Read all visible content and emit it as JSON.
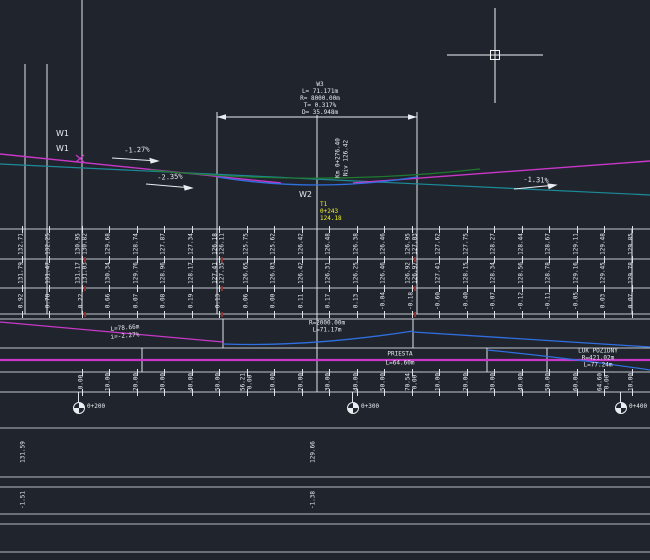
{
  "colors": {
    "background": "#20252d",
    "line_white": "#e9ecf1",
    "line_gray": "#b6bcc4",
    "magenta": "#c837c8",
    "teal": "#1d8a99",
    "blue": "#2f6fe0",
    "green": "#1f7a2f",
    "yellow": "#f2f22b",
    "red_tick": "#8b2f2f"
  },
  "annotations": {
    "w1_top": "W1",
    "w1_bottom": "W1",
    "w2": "W2",
    "w3_title": "W3",
    "w3_l": "L= 71.171m",
    "w3_r": "R= 8000.00m",
    "w3_t": "T= 0.317%",
    "w3_d": "D= 35.948m",
    "grade_left": "-1.27%",
    "grade_mid": "-2.35%",
    "grade_right": "-1.31%",
    "station_note_l1": "Km 0+276.40",
    "station_note_l2": "Niv 126.42",
    "vertex_l1": "T1",
    "vertex_l2": "0+243",
    "vertex_l3": "124.18"
  },
  "grade_diagram": {
    "seg_len": "L=78.66m",
    "seg_slope": "i=-2.27%",
    "curve_r": "R=2000.00m",
    "curve_len": "L=71.17m"
  },
  "alignment": {
    "tangent_name": "PRIESTA",
    "tangent_len": "L=64.60m",
    "curve_name": "LUK POZIDNY",
    "curve_r": "R=421.02m",
    "curve_len": "L=77.24m"
  },
  "bands": {
    "columns_x": [
      22,
      49,
      82,
      109,
      137,
      164,
      192,
      219,
      247,
      274,
      302,
      329,
      357,
      384,
      412,
      439,
      467,
      494,
      522,
      549,
      577,
      604,
      632
    ],
    "terrain": [
      "132.71",
      "132.25",
      "130.95|130.82",
      "129.68",
      "128.74",
      "127.87",
      "127.34",
      "126.18|126.11",
      "125.75",
      "125.62",
      "126.42",
      "126.48",
      "126.38",
      "126.46",
      "126.95|127.03",
      "127.62",
      "127.75",
      "128.27",
      "128.44",
      "128.67",
      "129.11",
      "129.48",
      "129.85"
    ],
    "design": [
      "131.79",
      "131.47",
      "131.17|131.03",
      "130.34",
      "129.76",
      "128.96",
      "128.17",
      "127.41|127.35",
      "126.65",
      "126.03",
      "126.42",
      "126.31",
      "126.25",
      "126.46",
      "126.92|126.97",
      "127.41",
      "128.15",
      "128.34",
      "128.56",
      "128.78",
      "129.16",
      "129.45",
      "129.78"
    ],
    "diff": [
      "0.92",
      "0.78",
      "0.22",
      "0.66",
      "0.07",
      "0.08",
      "0.19",
      "0.13",
      "0.06",
      "0.00",
      "0.11",
      "0.17",
      "0.13",
      "-0.04",
      "-0.18",
      "-0.60",
      "-0.40",
      "-0.07",
      "-0.12",
      "-0.11",
      "-0.05",
      "0.03",
      "0.07"
    ],
    "distances": [
      "0.00",
      "10.00",
      "20.00",
      "30.00",
      "40.00",
      "50.00",
      "56.21|0.00",
      "10.00",
      "20.00",
      "30.00",
      "40.00",
      "50.00",
      "70.54|0.00",
      "10.00",
      "20.00",
      "30.00",
      "40.00",
      "50.00",
      "60.00",
      "64.60|0.00",
      "10.00"
    ]
  },
  "red_ticks": {
    "xs": [
      82,
      219,
      412
    ],
    "ys": [
      259,
      288,
      314
    ]
  },
  "stations": [
    {
      "x": 78,
      "label": "0+200"
    },
    {
      "x": 352,
      "label": "0+300"
    },
    {
      "x": 620,
      "label": "0+400"
    }
  ],
  "bottom_rows": {
    "row1": [
      {
        "x": 24,
        "v": "131.59"
      },
      {
        "x": 314,
        "v": "129.66"
      }
    ],
    "row2": [
      {
        "x": 24,
        "v": "-1.51"
      },
      {
        "x": 314,
        "v": "-1.38"
      }
    ]
  }
}
